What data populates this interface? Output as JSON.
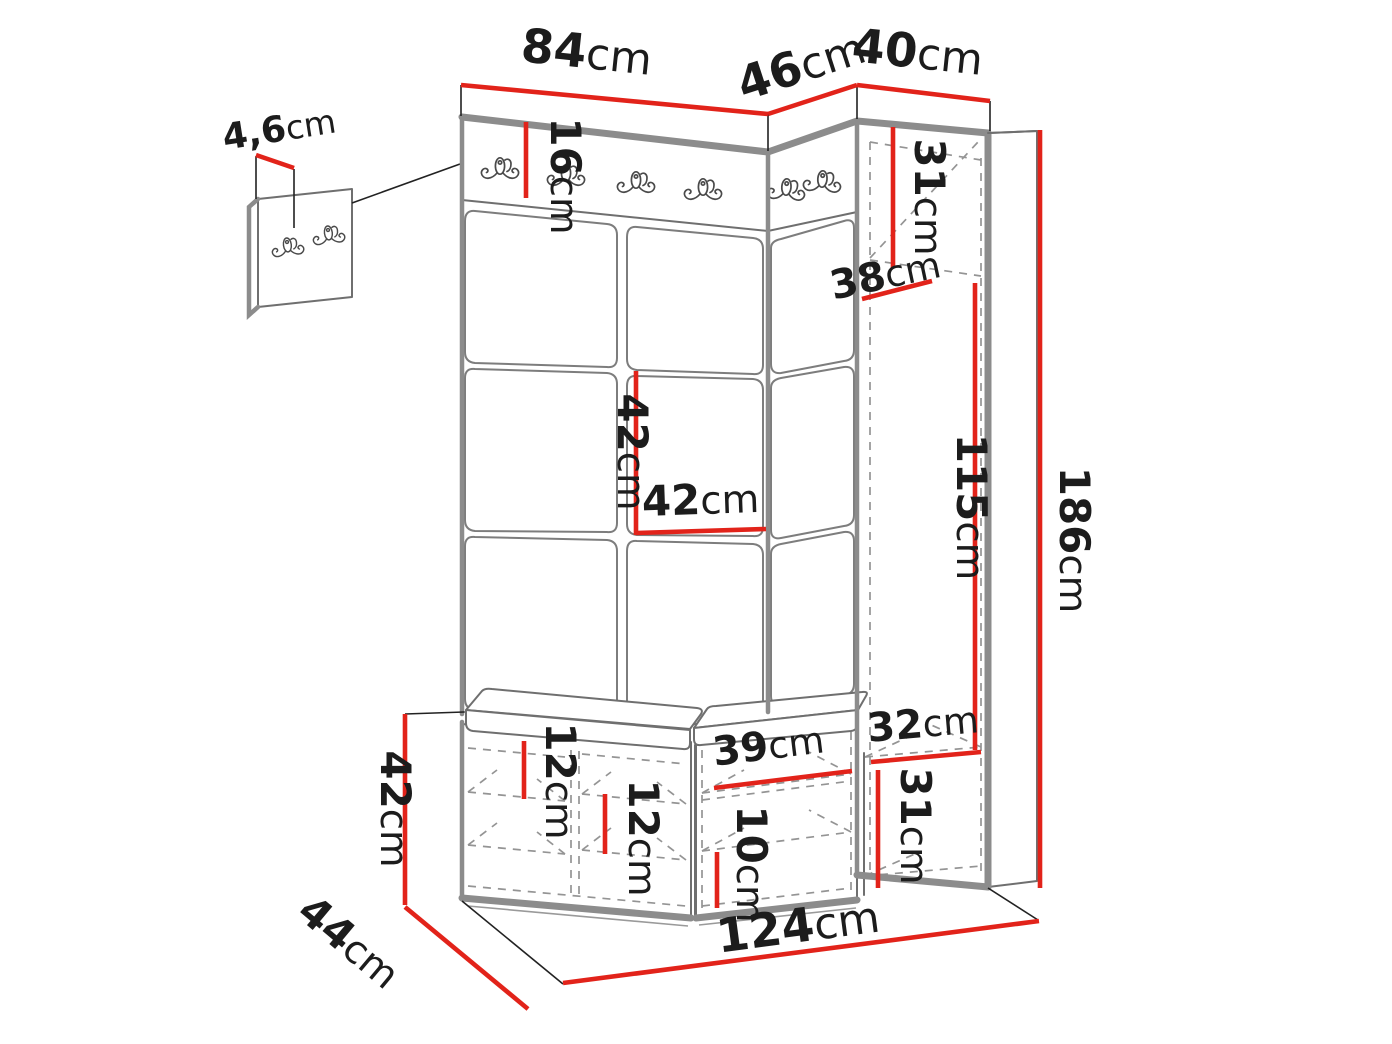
{
  "colors": {
    "dimension-red": "#e2231a",
    "outline-gray": "#8c8c8c",
    "line-dark": "#3c3c3c",
    "dashed-gray": "#949494",
    "label-black": "#1c1c1c"
  },
  "diagram": {
    "type": "furniture-dimension-drawing",
    "subject": "hallway wardrobe set with coat hooks, tall cabinet and shoe bench",
    "unit": "cm",
    "dimensions": {
      "main_panel_width": {
        "value": "84",
        "unit": "cm"
      },
      "corner_panel_width": {
        "value": "46",
        "unit": "cm"
      },
      "cabinet_width": {
        "value": "40",
        "unit": "cm"
      },
      "wall_panel_thickness": {
        "value": "4,6",
        "unit": "cm"
      },
      "hook_rail_height": {
        "value": "16",
        "unit": "cm"
      },
      "cabinet_top_section_height": {
        "value": "31",
        "unit": "cm"
      },
      "cabinet_shelf_depth": {
        "value": "38",
        "unit": "cm"
      },
      "panel_tile_height": {
        "value": "42",
        "unit": "cm"
      },
      "panel_tile_width": {
        "value": "42",
        "unit": "cm"
      },
      "hanging_space_height": {
        "value": "115",
        "unit": "cm"
      },
      "total_height": {
        "value": "186",
        "unit": "cm"
      },
      "lower_shelf_width": {
        "value": "32",
        "unit": "cm"
      },
      "lower_section_height": {
        "value": "31",
        "unit": "cm"
      },
      "bench_shelf_gap_top": {
        "value": "12",
        "unit": "cm"
      },
      "bench_shelf_gap_bottom": {
        "value": "12",
        "unit": "cm"
      },
      "bench_shelf_width": {
        "value": "39",
        "unit": "cm"
      },
      "bench_lower_gap": {
        "value": "10",
        "unit": "cm"
      },
      "bench_height": {
        "value": "42",
        "unit": "cm"
      },
      "bench_depth": {
        "value": "44",
        "unit": "cm"
      },
      "total_width": {
        "value": "124",
        "unit": "cm"
      }
    }
  }
}
